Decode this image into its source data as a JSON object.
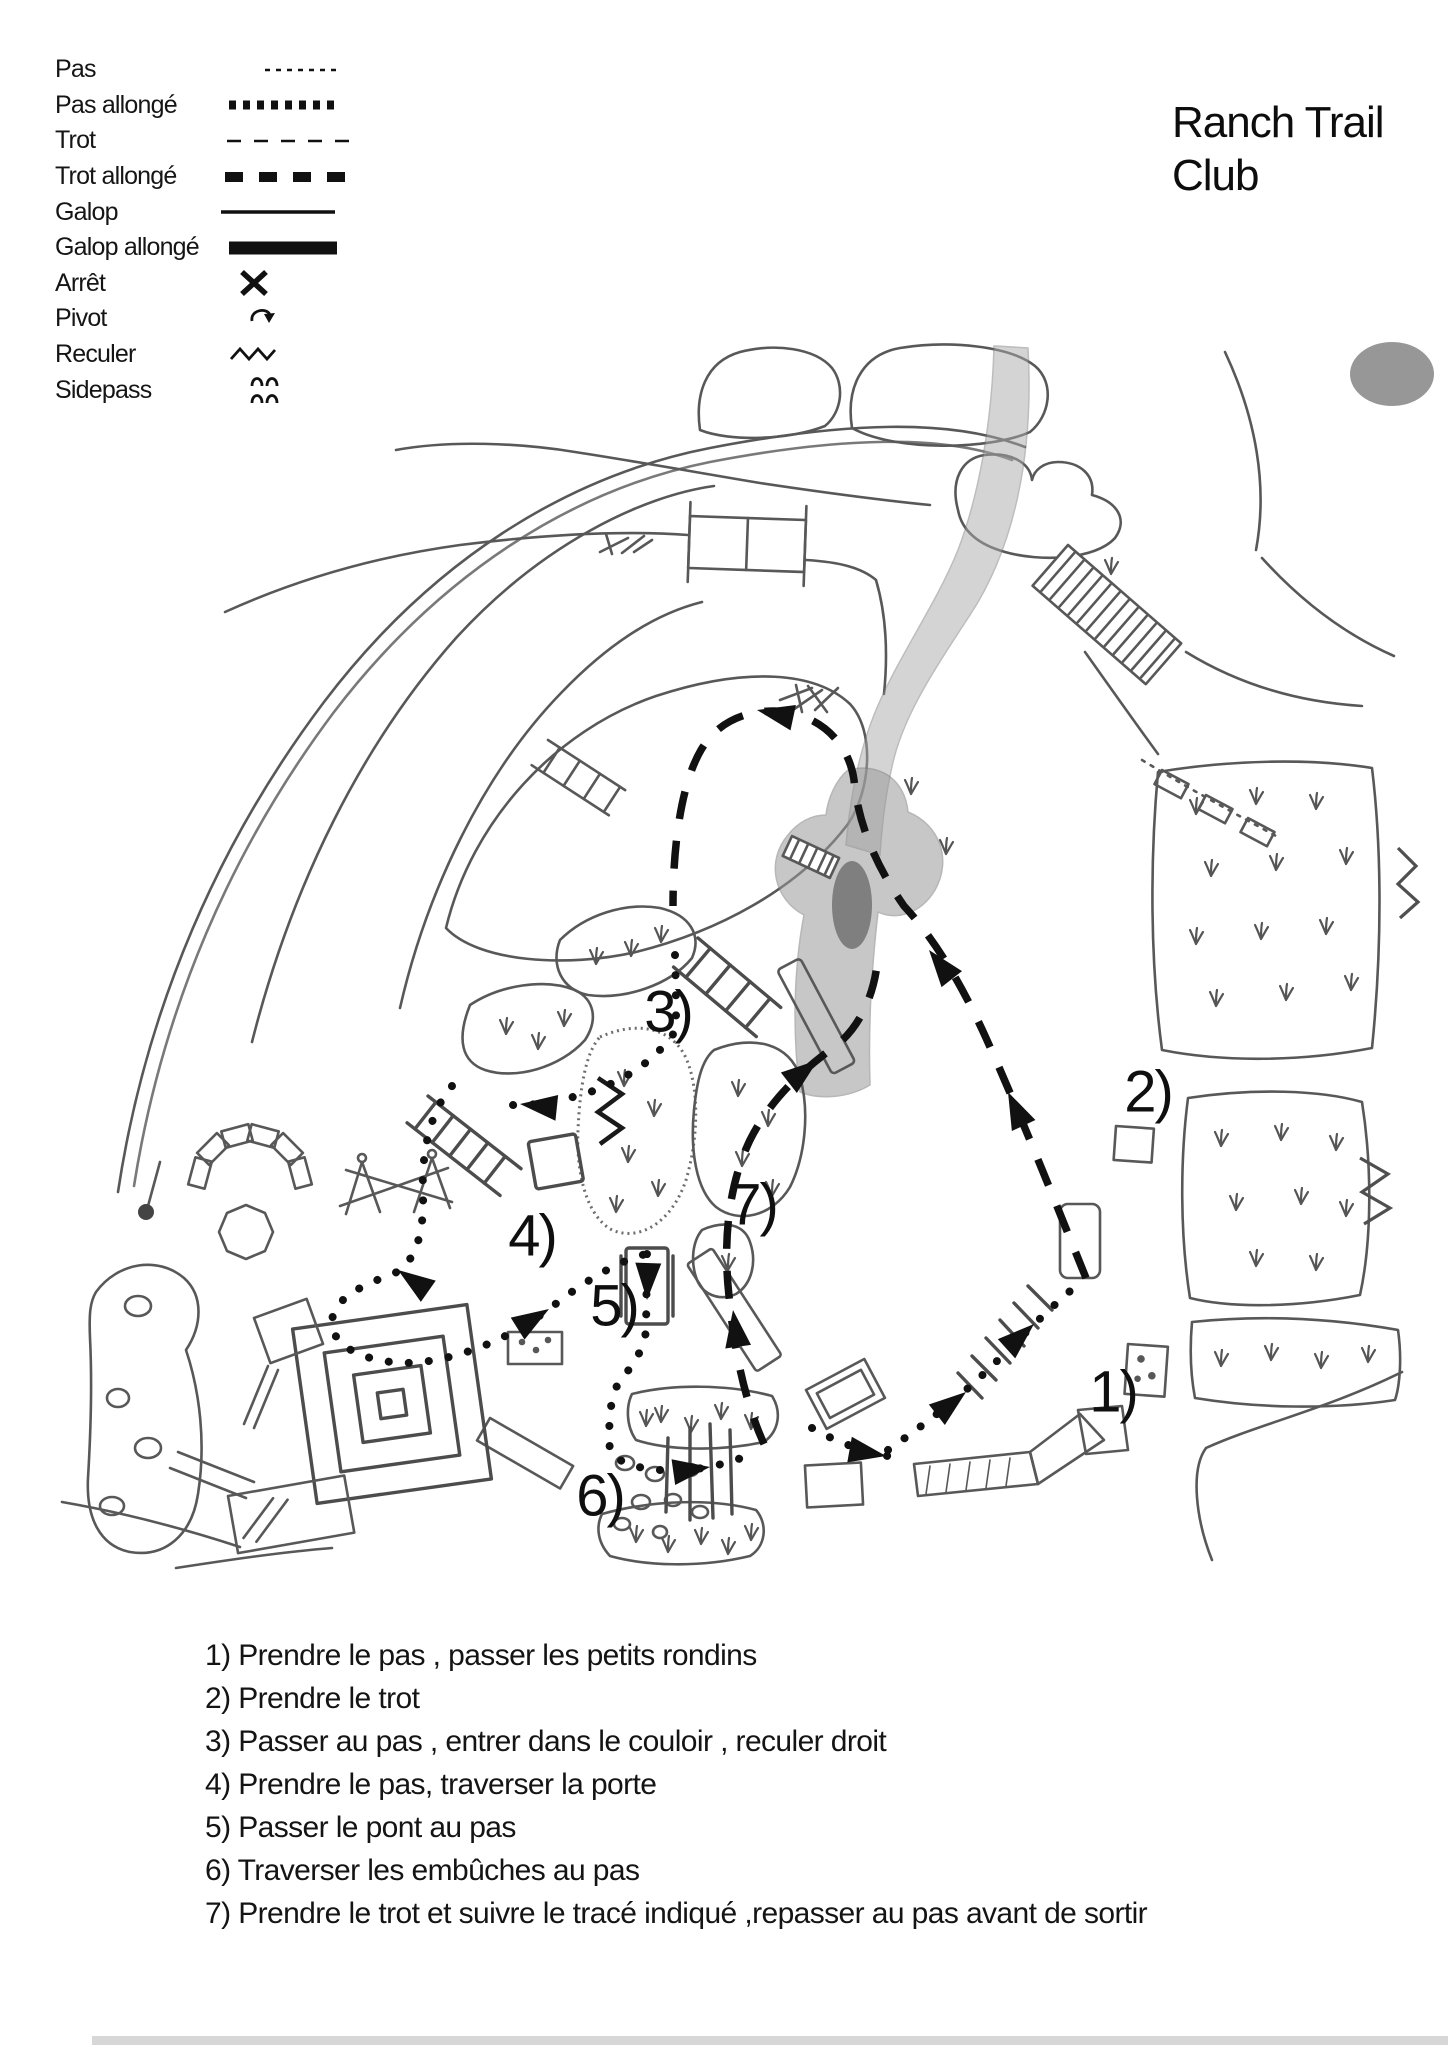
{
  "title": {
    "line1": "Ranch Trail",
    "line2": "Club"
  },
  "legend": {
    "items": [
      {
        "label": "Pas",
        "symbol": "fine-dotted-line"
      },
      {
        "label": "Pas allongé",
        "symbol": "bold-dotted-line"
      },
      {
        "label": "Trot",
        "symbol": "dashed-line"
      },
      {
        "label": "Trot allongé",
        "symbol": "bold-dashed-line"
      },
      {
        "label": "Galop",
        "symbol": "solid-line"
      },
      {
        "label": "Galop allongé",
        "symbol": "bold-solid-line"
      },
      {
        "label": "Arrêt",
        "symbol": "x-mark"
      },
      {
        "label": "Pivot",
        "symbol": "curved-arrow"
      },
      {
        "label": "Reculer",
        "symbol": "zigzag"
      },
      {
        "label": "Sidepass",
        "symbol": "double-arches"
      }
    ]
  },
  "map": {
    "ink": "#111111",
    "pencil": "#585858",
    "markers": [
      {
        "label": "1)",
        "x": 1113,
        "y": 1392
      },
      {
        "label": "2)",
        "x": 1148,
        "y": 1092
      },
      {
        "label": "3)",
        "x": 668,
        "y": 1012
      },
      {
        "label": "4)",
        "x": 532,
        "y": 1236
      },
      {
        "label": "5)",
        "x": 614,
        "y": 1306
      },
      {
        "label": "6)",
        "x": 600,
        "y": 1496
      },
      {
        "label": "7)",
        "x": 753,
        "y": 1205
      }
    ]
  },
  "instructions": {
    "items": [
      "1) Prendre le pas , passer les petits rondins",
      "2) Prendre le trot",
      "3) Passer au pas , entrer dans le couloir , reculer droit",
      "4) Prendre le pas, traverser la porte",
      "5) Passer le pont au pas",
      "6) Traverser les embûches au pas",
      "7) Prendre le trot et suivre le tracé indiqué ,repasser au pas avant de sortir"
    ]
  }
}
